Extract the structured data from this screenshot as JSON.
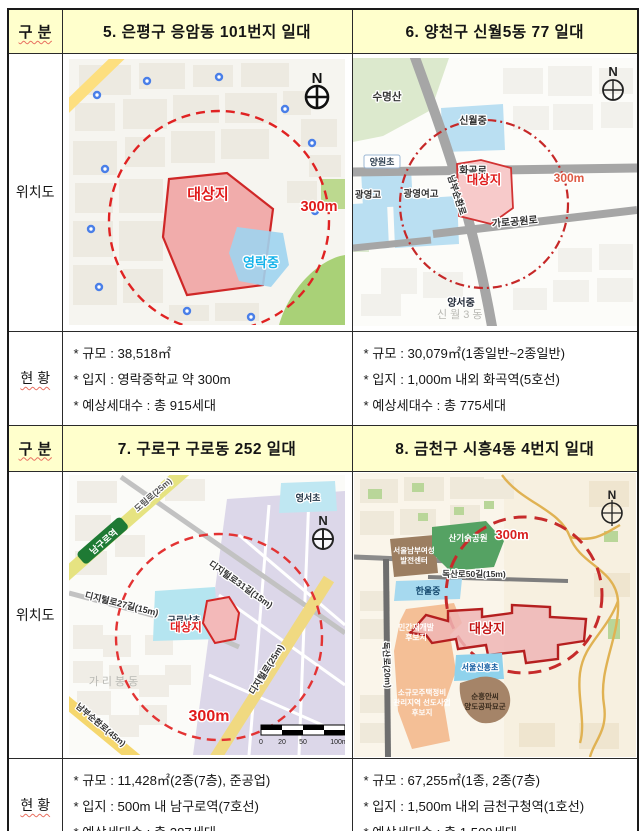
{
  "table": {
    "col_header_label": "구 분",
    "map_row_label": "위치도",
    "status_row_label": "현 황"
  },
  "sections": [
    {
      "title": "5. 은평구 응암동 101번지 일대",
      "bullets": [
        "* 규모 : 38,518㎡",
        "* 입지 : 영락중학교 약 300m",
        "* 예상세대수 : 총 915세대"
      ],
      "map": {
        "target": "대상지",
        "radius": "300m",
        "school": "영락중",
        "compass": "N"
      }
    },
    {
      "title": "6. 양천구 신월5동 77 일대",
      "bullets": [
        "* 규모 : 30,079㎡(1종일반~2종일반)",
        "* 입지 : 1,000m 내외 화곡역(5호선)",
        "* 예상세대수 : 총 775세대"
      ],
      "map": {
        "target": "대상지",
        "radius": "300m",
        "compass": "N",
        "mountain": "수명산",
        "school1": "신월중",
        "school2": "양원초",
        "school3": "광영여고",
        "school4": "광영고",
        "school5": "양서중",
        "road1": "화곡로",
        "road2": "가로공원로",
        "road3": "남부순환로",
        "district": "신월3동"
      }
    },
    {
      "title": "7. 구로구 구로동 252 일대",
      "bullets": [
        "* 규모 : 11,428㎡(2종(7층), 준공업)",
        "* 입지 : 500m 내 남구로역(7호선)",
        "* 예상세대수 : 총 287세대"
      ],
      "map": {
        "target": "대상지",
        "radius": "300m",
        "compass": "N",
        "station": "남구로역",
        "road1": "도림로(25m)",
        "road2": "디지털로31길(15m)",
        "road3": "디지털로27길(15m)",
        "road4": "남부순환로(45m)",
        "road5": "디지털로(25m)",
        "school1": "구로남초",
        "school2": "영서초",
        "district": "가리봉동",
        "scale": [
          "0",
          "20",
          "50",
          "100m"
        ]
      }
    },
    {
      "title": "8. 금천구 시흥4동 4번지 일대",
      "bullets": [
        "* 규모 : 67,255㎡(1종, 2종(7층)",
        "* 입지 : 1,500m 내외 금천구청역(1호선)",
        "* 예상세대수 : 총 1,509세대"
      ],
      "map": {
        "target": "대상지",
        "radius": "300m",
        "compass": "N",
        "park": "산기슭공원",
        "center1": "서울남부여성",
        "center2": "발전센터",
        "school1": "한울중",
        "school2": "서울신흥초",
        "road1": "독산로50길(15m)",
        "road2": "독산로(20m)",
        "zone1a": "민간재개발",
        "zone1b": "후보지",
        "zone2a": "소규모주택정비",
        "zone2b": "관리지역 선도사업",
        "zone2c": "후보지",
        "tomb1": "순흥안씨",
        "tomb2": "양도공파묘군"
      }
    }
  ]
}
